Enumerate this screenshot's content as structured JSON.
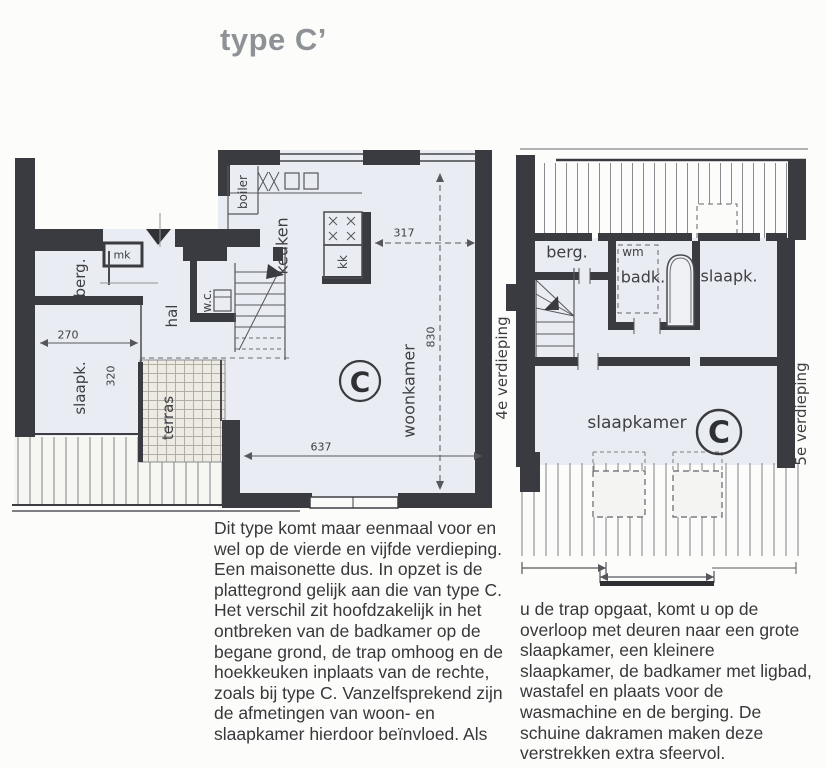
{
  "title": "type C’",
  "plan_left": {
    "floor_label": "4e verdieping",
    "unit_label": "C",
    "rooms": {
      "berg": "berg.",
      "mk": "mk",
      "hal": "hal",
      "wc": "w.c.",
      "boiler": "boiler",
      "keuken": "keuken",
      "kk": "kk",
      "slaapk": "slaapk.",
      "terras": "terras",
      "woonkamer": "woonkamer"
    },
    "dims": {
      "slaapk_breedte": "270",
      "slaapk_diepte": "320",
      "keuken_breedte": "317",
      "woonkamer_diepte": "830",
      "woonkamer_breedte": "637"
    }
  },
  "plan_right": {
    "floor_label": "5e verdieping",
    "unit_label": "C",
    "rooms": {
      "berg": "berg.",
      "wm": "wm",
      "badk": "badk.",
      "slaapk": "slaapk.",
      "slaapkamer": "slaapkamer"
    }
  },
  "description": {
    "col_left": "Dit type komt maar eenmaal voor en wel op de vierde en vijfde verdieping. Een maisonette dus. In opzet is de plattegrond gelijk aan die van type C. Het verschil zit hoofdzakelijk in het ontbreken van de badkamer op de begane grond, de trap omhoog en de hoekkeuken inplaats van de rechte, zoals bij type C. Vanzelfsprekend zijn de afmetingen van woon- en slaapkamer hierdoor beïnvloed. Als",
    "col_right": "u de trap opgaat, komt u op de overloop met deuren naar een grote slaapkamer, een kleinere slaapkamer, de badkamer met ligbad, wastafel en plaats voor de wasmachine en de berging. De schuine dakramen maken deze verstrekken extra sfeervol."
  },
  "colors": {
    "wall": "#3a3b40",
    "floor": "#e9ecf2",
    "line": "#56575c",
    "title": "#8e9296",
    "text": "#37383b"
  }
}
